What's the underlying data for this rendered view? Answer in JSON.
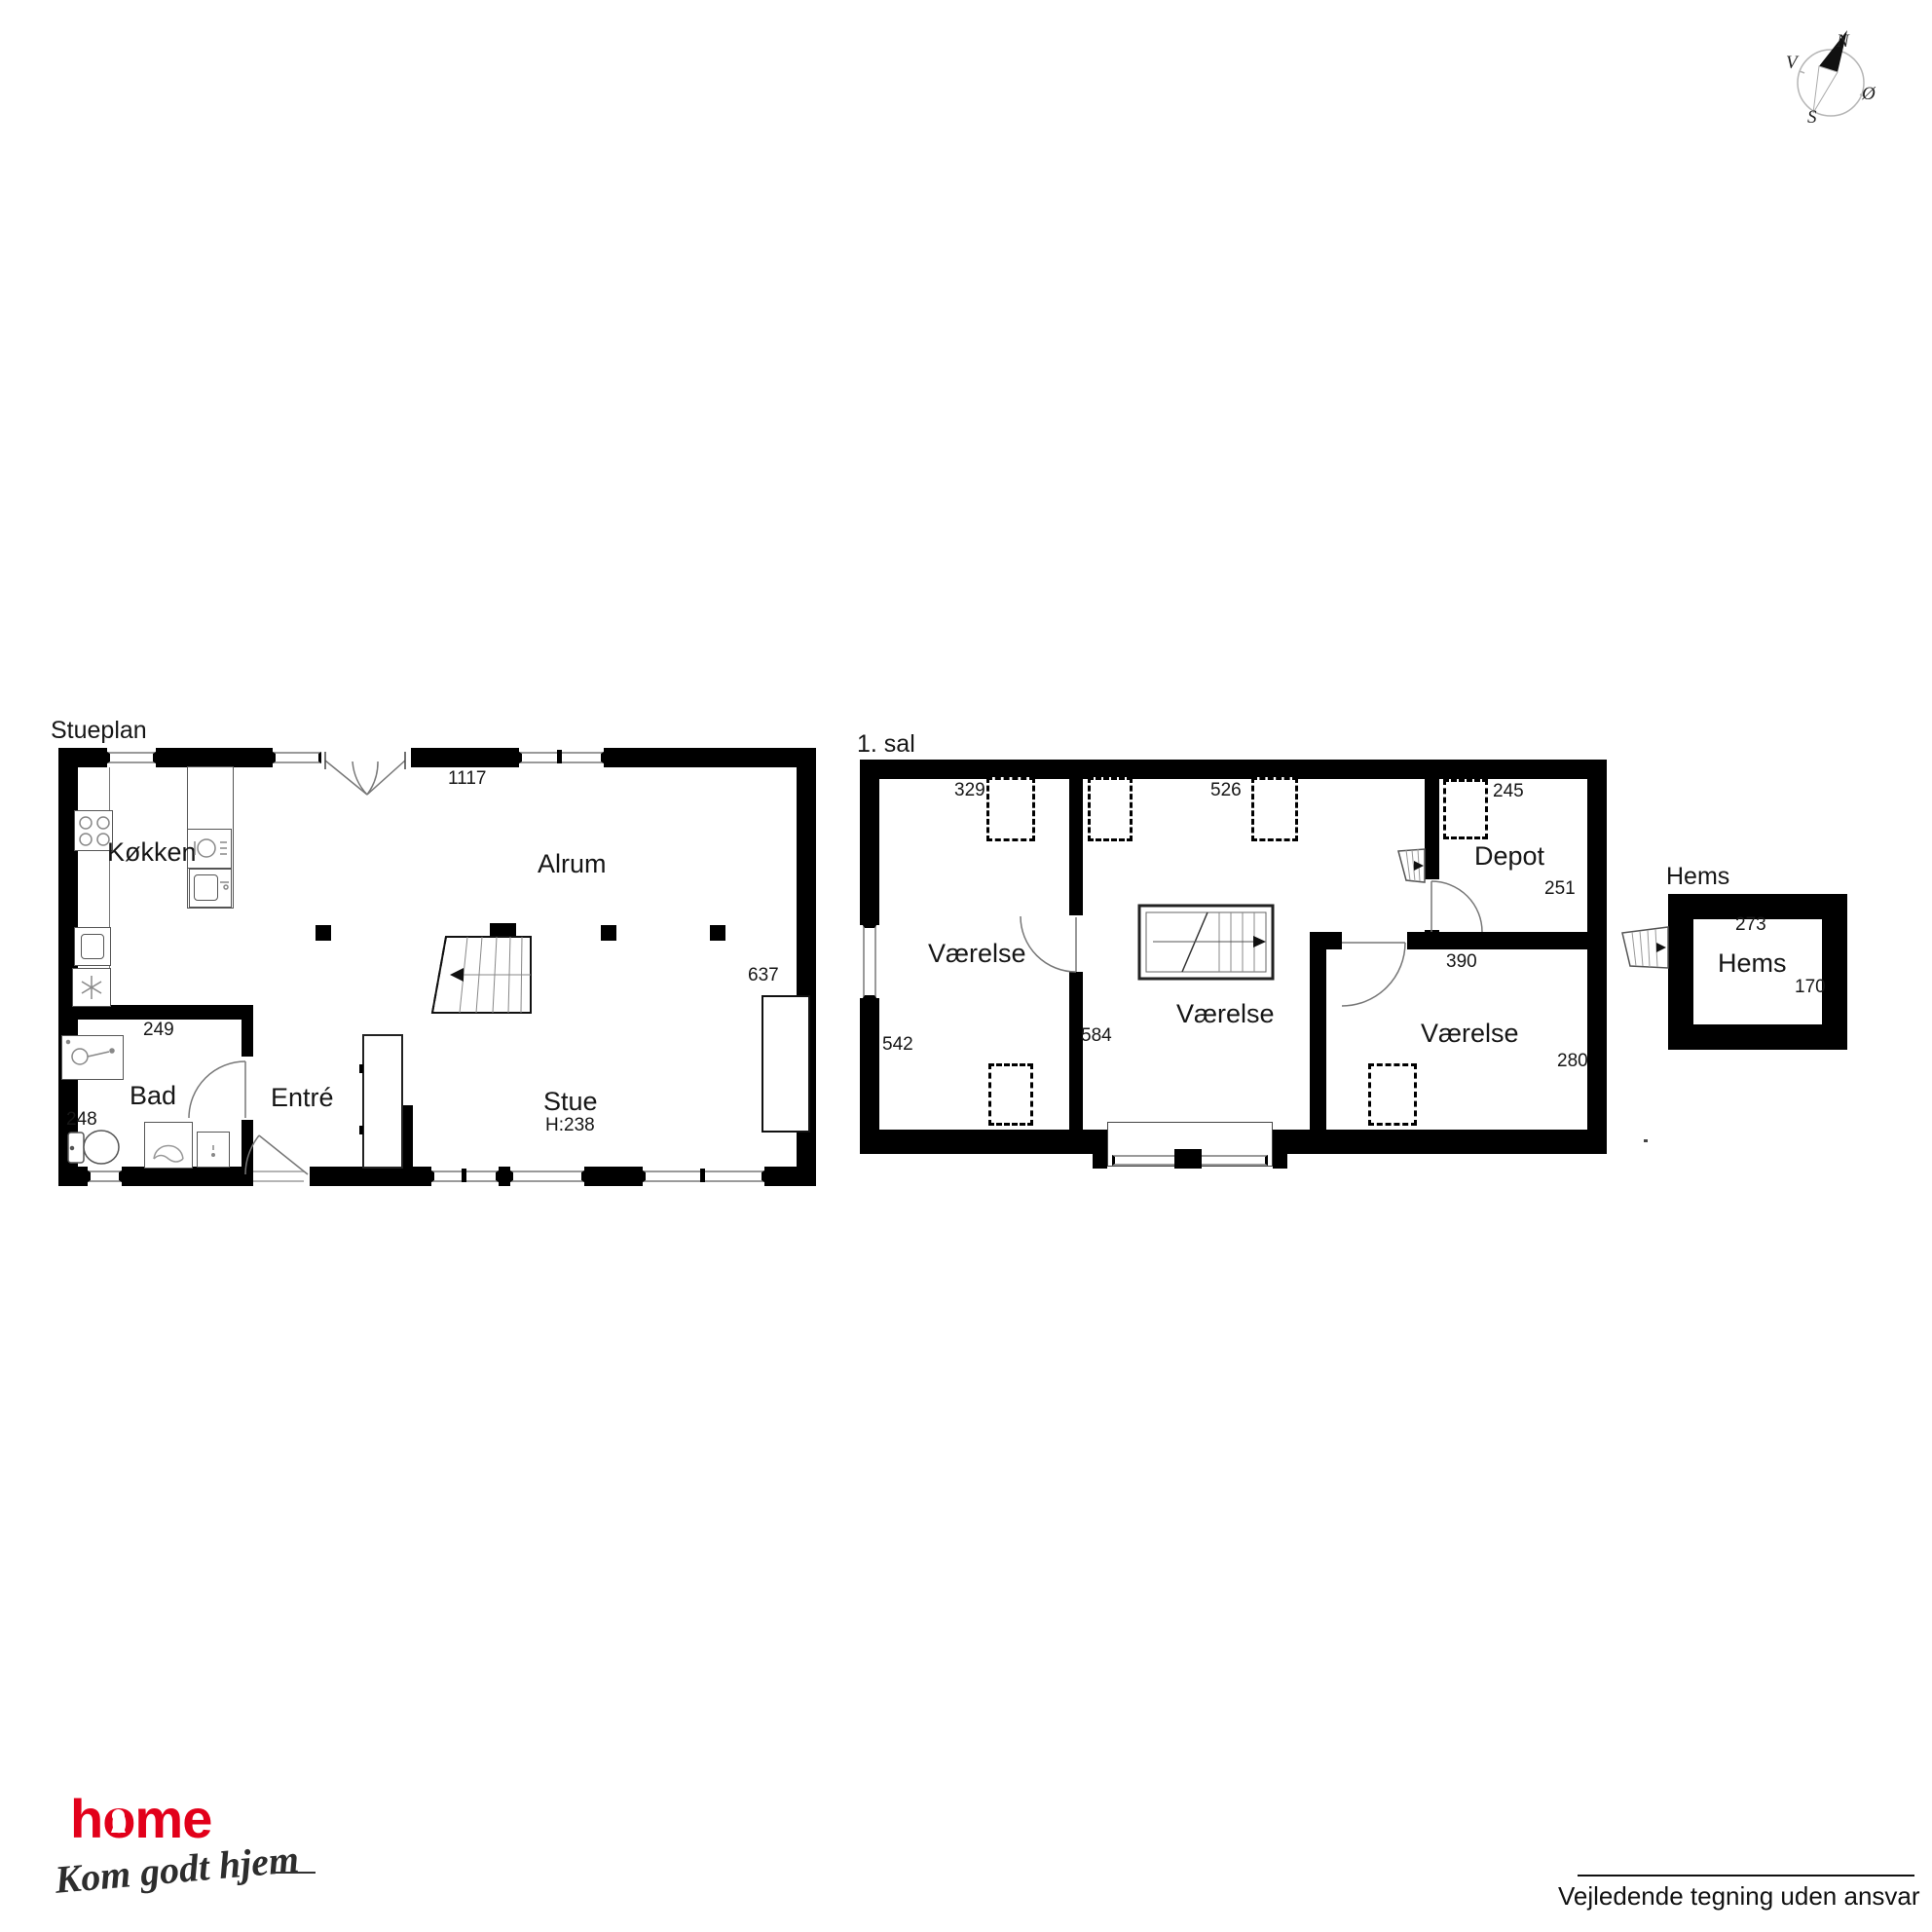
{
  "stueplan": {
    "title": "Stueplan",
    "kitchen": "Køkken",
    "open_area": "Alrum",
    "bath": "Bad",
    "entry": "Entré",
    "living": "Stue",
    "ceiling_height": "H:238",
    "dim_top": "1117",
    "dim_right": "637",
    "dim_bath_w": "249",
    "dim_bath_h": "248"
  },
  "first_floor": {
    "title": "1. sal",
    "room_left": "Værelse",
    "room_mid": "Værelse",
    "room_right": "Værelse",
    "depot": "Depot",
    "dim_sky_left": "329",
    "dim_sky_mid": "526",
    "dim_sky_depot": "245",
    "dim_depot": "251",
    "dim_left": "542",
    "dim_mid": "584",
    "dim_room_right_w": "390",
    "dim_room_right_h": "280"
  },
  "hems": {
    "title": "Hems",
    "room": "Hems",
    "dim_w": "273",
    "dim_h": "170"
  },
  "compass": {
    "north": "N",
    "south": "S",
    "east": "Ø",
    "west": "V"
  },
  "branding": {
    "logo": "home",
    "tagline": "Kom godt hjem"
  },
  "footer": {
    "disclaimer": "Vejledende tegning uden ansvar"
  },
  "colors": {
    "wall": "#000000",
    "window": "#9a9a9a",
    "logo_red": "#e2001a"
  }
}
